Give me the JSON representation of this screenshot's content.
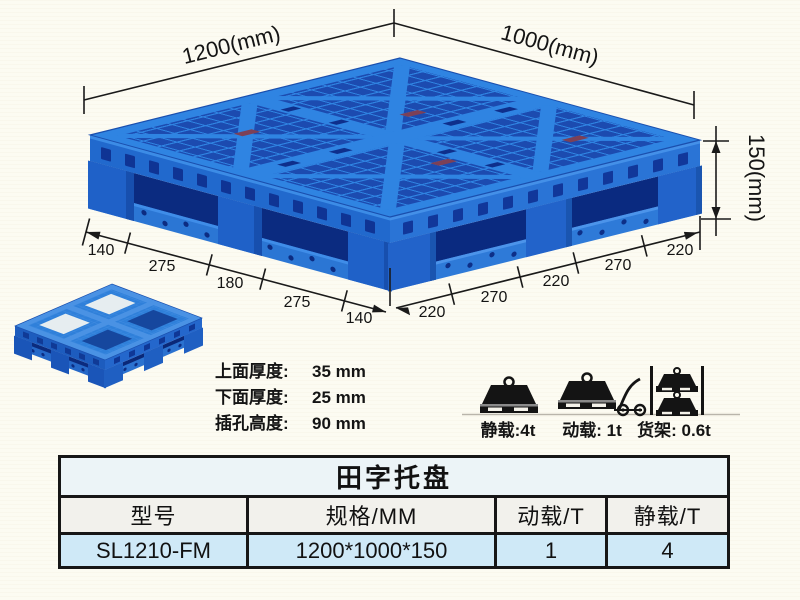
{
  "dimensions": {
    "length_label": "1200(mm)",
    "width_label": "1000(mm)",
    "height_label": "150(mm)",
    "left_edge_segments": [
      "140",
      "275",
      "180",
      "275",
      "140"
    ],
    "right_edge_segments": [
      "220",
      "270",
      "220",
      "270",
      "220"
    ]
  },
  "specs": {
    "lines": [
      {
        "label": "上面厚度:",
        "value": "35 mm"
      },
      {
        "label": "下面厚度:",
        "value": "25 mm"
      },
      {
        "label": "插孔高度:",
        "value": "90 mm"
      }
    ]
  },
  "load_ratings": [
    {
      "name": "static-load",
      "label": "静载:4t"
    },
    {
      "name": "dynamic-load",
      "label": "动载: 1t"
    },
    {
      "name": "rack-load",
      "label": "货架: 0.6t"
    }
  ],
  "table": {
    "title": "田字托盘",
    "headers": [
      "型号",
      "规格/MM",
      "动载/T",
      "静载/T"
    ],
    "rows": [
      [
        "SL1210-FM",
        "1200*1000*150",
        "1",
        "4"
      ]
    ]
  },
  "colors": {
    "pallet_blue": "#2f80da",
    "pallet_rib_blue": "#2f84e2",
    "pallet_dark_blue": "#0b2b80",
    "table_data_row": "#cfe9f7",
    "table_title_bg": "#ecf4f7",
    "background": "#fcfbf2",
    "line_color": "#1a1a1a"
  }
}
